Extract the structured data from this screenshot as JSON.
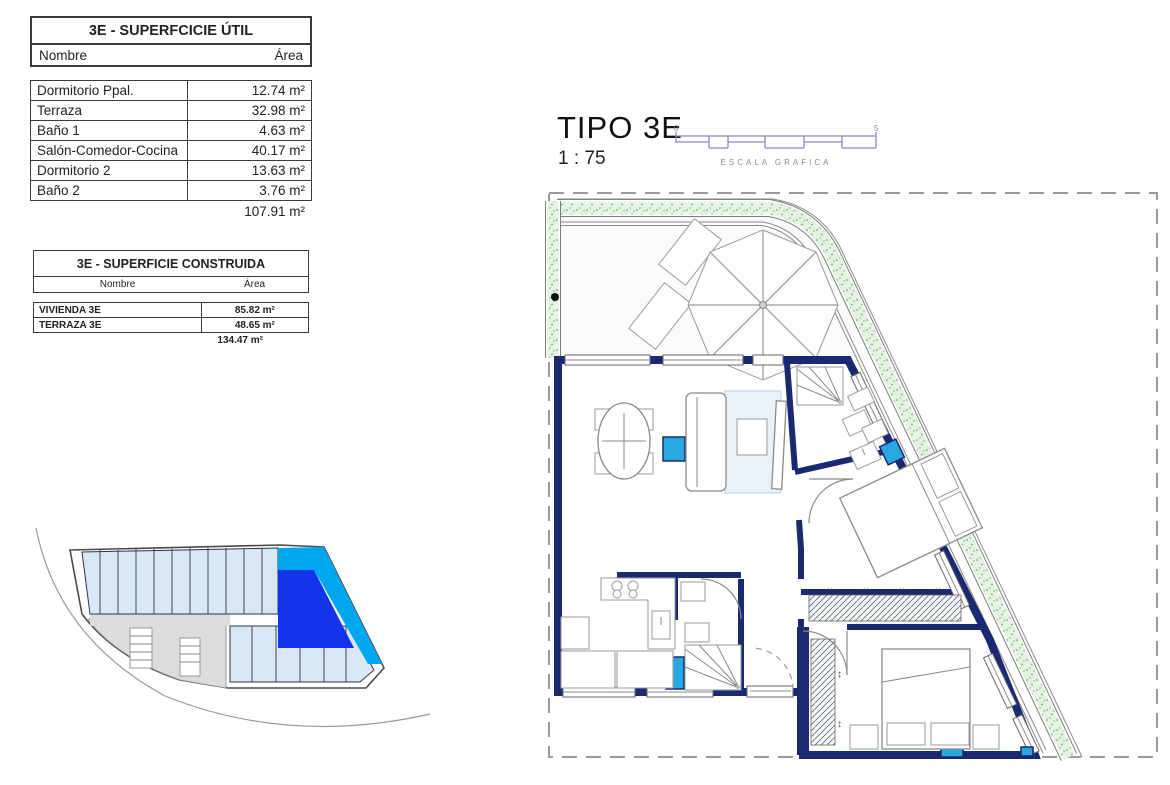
{
  "superficie_util": {
    "title": "3E - SUPERFCICIE ÚTIL",
    "col_nombre": "Nombre",
    "col_area": "Área",
    "rows": [
      {
        "nombre": "Dormitorio Ppal.",
        "area": "12.74 m²"
      },
      {
        "nombre": "Terraza",
        "area": "32.98 m²"
      },
      {
        "nombre": "Baño 1",
        "area": "4.63 m²"
      },
      {
        "nombre": "Salón-Comedor-Cocina",
        "area": "40.17 m²"
      },
      {
        "nombre": "Dormitorio 2",
        "area": "13.63 m²"
      },
      {
        "nombre": "Baño 2",
        "area": "3.76 m²"
      }
    ],
    "total": "107.91 m²"
  },
  "superficie_construida": {
    "title": "3E - SUPERFICIE CONSTRUIDA",
    "col_nombre": "Nombre",
    "col_area": "Área",
    "rows": [
      {
        "nombre": "VIVIENDA 3E",
        "area": "85.82 m²"
      },
      {
        "nombre": "TERRAZA 3E",
        "area": "48.65 m²"
      }
    ],
    "total": "134.47 m²"
  },
  "plan": {
    "title": "TIPO 3E",
    "scale": "1 : 75",
    "scale_bar": {
      "start": "0",
      "end": "5",
      "label": "ESCALA GRAFICA"
    }
  },
  "colors": {
    "wall": "#1b2a70",
    "floor": "#dce9f5",
    "floorline": "#c9dcee",
    "cyan": "#29a8e0",
    "green": "#e4f3e2",
    "greendot": "#6fae6f",
    "hiblue": "#1334ea",
    "hicyan": "#00a7ee",
    "scalebar": "#8888cc",
    "unitblue": "#d9e8f7"
  }
}
